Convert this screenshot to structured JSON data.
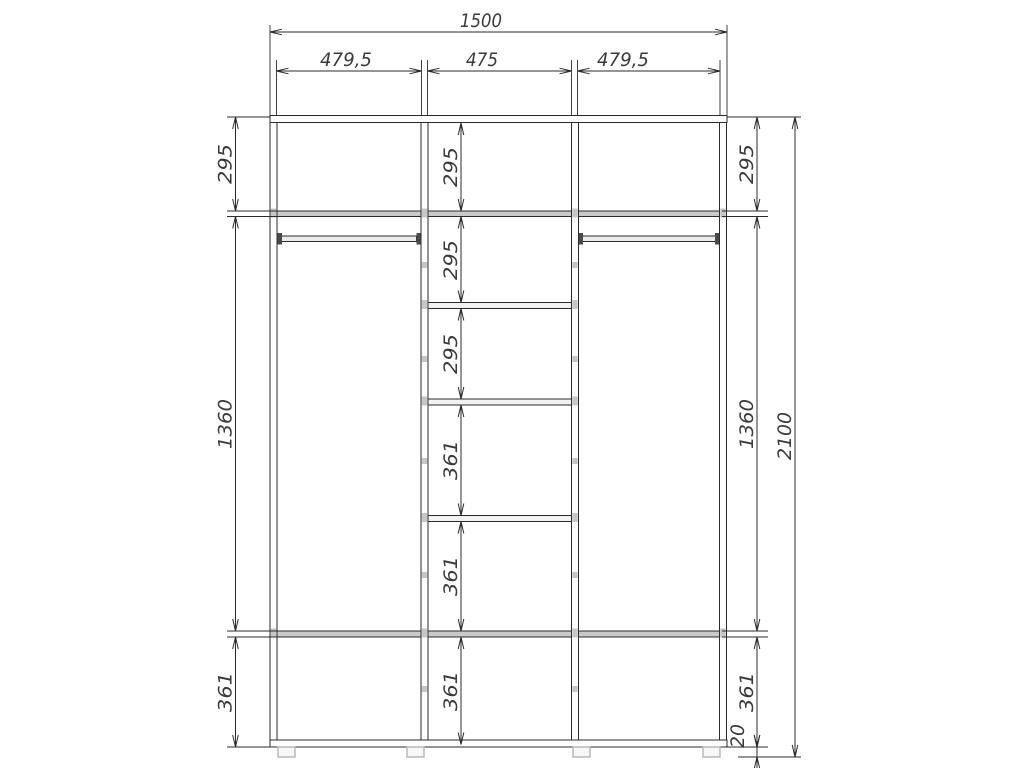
{
  "canvas": {
    "width": 1024,
    "height": 768,
    "background": "#ffffff"
  },
  "style": {
    "line_color": "#2b2b2b",
    "dim_color": "#2b2b2b",
    "text_color": "#3a3a3a",
    "font_size": 19,
    "kinds": {
      "panel": {
        "fill": "#fdfdfd",
        "stroke": "#2b2b2b",
        "sw": 1
      },
      "shelf": {
        "fill": "#c9c9c9",
        "stroke": "#2b2b2b",
        "sw": 1
      },
      "inner_shelf": {
        "fill": "#f2f2f2",
        "stroke": "#2b2b2b",
        "sw": 1
      },
      "rod": {
        "fill": "#ececec",
        "stroke": "#2b2b2b",
        "sw": 1
      },
      "bracket": {
        "fill": "#4a4a4a",
        "stroke": "none",
        "sw": 0
      },
      "foot": {
        "fill": "#f7f7f7",
        "stroke": "#b5b5b5",
        "sw": 1.4
      },
      "fastener": {
        "fill": "#c6c6c6",
        "stroke": "none",
        "sw": 0
      }
    }
  },
  "drawing": {
    "rects": [
      {
        "name": "top-shelf-full",
        "kind": "shelf",
        "x": 277,
        "y": 211,
        "w": 442.5,
        "h": 5.5
      },
      {
        "name": "bottom-shelf-full",
        "kind": "shelf",
        "x": 277,
        "y": 631,
        "w": 442.5,
        "h": 6
      },
      {
        "name": "middle-shelf-1",
        "kind": "inner_shelf",
        "x": 428,
        "y": 302.5,
        "w": 143.5,
        "h": 6
      },
      {
        "name": "middle-shelf-2",
        "kind": "inner_shelf",
        "x": 428,
        "y": 399,
        "w": 143.5,
        "h": 6
      },
      {
        "name": "middle-shelf-3",
        "kind": "inner_shelf",
        "x": 428,
        "y": 515.5,
        "w": 143.5,
        "h": 6
      },
      {
        "name": "hanging-rod-left",
        "kind": "rod",
        "x": 281.5,
        "y": 236,
        "w": 135,
        "h": 5.5
      },
      {
        "name": "hanging-rod-right",
        "kind": "rod",
        "x": 582.5,
        "y": 236,
        "w": 133,
        "h": 5.5
      },
      {
        "name": "rod-bracket",
        "kind": "bracket",
        "x": 277.5,
        "y": 233,
        "w": 4.5,
        "h": 11.5
      },
      {
        "name": "rod-bracket",
        "kind": "bracket",
        "x": 416.5,
        "y": 233,
        "w": 4.5,
        "h": 11.5
      },
      {
        "name": "rod-bracket",
        "kind": "bracket",
        "x": 578.5,
        "y": 233,
        "w": 4.5,
        "h": 11.5
      },
      {
        "name": "rod-bracket",
        "kind": "bracket",
        "x": 715,
        "y": 233,
        "w": 4.5,
        "h": 11.5
      },
      {
        "name": "top-panel",
        "kind": "panel",
        "x": 270,
        "y": 115.5,
        "w": 457,
        "h": 7
      },
      {
        "name": "bottom-panel",
        "kind": "panel",
        "x": 270,
        "y": 740,
        "w": 457,
        "h": 7
      },
      {
        "name": "left-side-panel",
        "kind": "panel",
        "x": 270,
        "y": 122.5,
        "w": 7,
        "h": 617.5
      },
      {
        "name": "left-partition",
        "kind": "panel",
        "x": 421,
        "y": 122.5,
        "w": 7,
        "h": 617.5
      },
      {
        "name": "right-partition",
        "kind": "panel",
        "x": 571.5,
        "y": 122.5,
        "w": 7,
        "h": 617.5
      },
      {
        "name": "right-side-panel",
        "kind": "panel",
        "x": 719.5,
        "y": 122.5,
        "w": 7,
        "h": 617.5
      },
      {
        "name": "fastener-mark",
        "kind": "fastener",
        "x": 421.8,
        "y": 208.5,
        "w": 5.4,
        "h": 9
      },
      {
        "name": "fastener-mark",
        "kind": "fastener",
        "x": 421.8,
        "y": 300,
        "w": 5.4,
        "h": 9
      },
      {
        "name": "fastener-mark",
        "kind": "fastener",
        "x": 421.8,
        "y": 396.5,
        "w": 5.4,
        "h": 9
      },
      {
        "name": "fastener-mark",
        "kind": "fastener",
        "x": 421.8,
        "y": 513,
        "w": 5.4,
        "h": 9
      },
      {
        "name": "fastener-mark",
        "kind": "fastener",
        "x": 421.8,
        "y": 628.5,
        "w": 5.4,
        "h": 9
      },
      {
        "name": "fastener-mark",
        "kind": "fastener",
        "x": 572.3,
        "y": 208.5,
        "w": 5.4,
        "h": 9
      },
      {
        "name": "fastener-mark",
        "kind": "fastener",
        "x": 572.3,
        "y": 300,
        "w": 5.4,
        "h": 9
      },
      {
        "name": "fastener-mark",
        "kind": "fastener",
        "x": 572.3,
        "y": 396.5,
        "w": 5.4,
        "h": 9
      },
      {
        "name": "fastener-mark",
        "kind": "fastener",
        "x": 572.3,
        "y": 513,
        "w": 5.4,
        "h": 9
      },
      {
        "name": "fastener-mark",
        "kind": "fastener",
        "x": 572.3,
        "y": 628.5,
        "w": 5.4,
        "h": 9
      },
      {
        "name": "fastener-mark",
        "kind": "fastener",
        "x": 270.8,
        "y": 208.5,
        "w": 5.4,
        "h": 9
      },
      {
        "name": "fastener-mark",
        "kind": "fastener",
        "x": 720.3,
        "y": 208.5,
        "w": 5.4,
        "h": 9
      },
      {
        "name": "fastener-mark",
        "kind": "fastener",
        "x": 270.8,
        "y": 628.5,
        "w": 5.4,
        "h": 9
      },
      {
        "name": "fastener-mark",
        "kind": "fastener",
        "x": 720.3,
        "y": 628.5,
        "w": 5.4,
        "h": 9
      },
      {
        "name": "fastener-mark",
        "kind": "fastener",
        "x": 421.8,
        "y": 262,
        "w": 5.4,
        "h": 6
      },
      {
        "name": "fastener-mark",
        "kind": "fastener",
        "x": 421.8,
        "y": 356,
        "w": 5.4,
        "h": 6
      },
      {
        "name": "fastener-mark",
        "kind": "fastener",
        "x": 421.8,
        "y": 458,
        "w": 5.4,
        "h": 6
      },
      {
        "name": "fastener-mark",
        "kind": "fastener",
        "x": 421.8,
        "y": 572,
        "w": 5.4,
        "h": 6
      },
      {
        "name": "fastener-mark",
        "kind": "fastener",
        "x": 421.8,
        "y": 686,
        "w": 5.4,
        "h": 6
      },
      {
        "name": "fastener-mark",
        "kind": "fastener",
        "x": 572.3,
        "y": 262,
        "w": 5.4,
        "h": 6
      },
      {
        "name": "fastener-mark",
        "kind": "fastener",
        "x": 572.3,
        "y": 356,
        "w": 5.4,
        "h": 6
      },
      {
        "name": "fastener-mark",
        "kind": "fastener",
        "x": 572.3,
        "y": 458,
        "w": 5.4,
        "h": 6
      },
      {
        "name": "fastener-mark",
        "kind": "fastener",
        "x": 572.3,
        "y": 572,
        "w": 5.4,
        "h": 6
      },
      {
        "name": "fastener-mark",
        "kind": "fastener",
        "x": 572.3,
        "y": 686,
        "w": 5.4,
        "h": 6
      },
      {
        "name": "foot",
        "kind": "foot",
        "x": 278,
        "y": 747,
        "w": 17,
        "h": 10
      },
      {
        "name": "foot",
        "kind": "foot",
        "x": 407,
        "y": 747,
        "w": 17,
        "h": 10
      },
      {
        "name": "foot",
        "kind": "foot",
        "x": 573,
        "y": 747,
        "w": 17,
        "h": 10
      },
      {
        "name": "foot",
        "kind": "foot",
        "x": 703,
        "y": 747,
        "w": 17,
        "h": 10
      }
    ],
    "extension_lines": [
      {
        "x1": 270,
        "y1": 25,
        "x2": 270,
        "y2": 115
      },
      {
        "x1": 276.5,
        "y1": 60,
        "x2": 276.5,
        "y2": 115
      },
      {
        "x1": 421.5,
        "y1": 60,
        "x2": 421.5,
        "y2": 115
      },
      {
        "x1": 427.5,
        "y1": 60,
        "x2": 427.5,
        "y2": 115
      },
      {
        "x1": 571.5,
        "y1": 60,
        "x2": 571.5,
        "y2": 115
      },
      {
        "x1": 577.5,
        "y1": 60,
        "x2": 577.5,
        "y2": 115
      },
      {
        "x1": 720,
        "y1": 60,
        "x2": 720,
        "y2": 115
      },
      {
        "x1": 727,
        "y1": 25,
        "x2": 727,
        "y2": 115
      },
      {
        "x1": 227,
        "y1": 117,
        "x2": 270,
        "y2": 117
      },
      {
        "x1": 227,
        "y1": 211,
        "x2": 277,
        "y2": 211
      },
      {
        "x1": 227,
        "y1": 216.5,
        "x2": 277,
        "y2": 216.5
      },
      {
        "x1": 227,
        "y1": 631,
        "x2": 277,
        "y2": 631
      },
      {
        "x1": 227,
        "y1": 637,
        "x2": 277,
        "y2": 637
      },
      {
        "x1": 227,
        "y1": 747,
        "x2": 270,
        "y2": 747
      },
      {
        "x1": 727,
        "y1": 117,
        "x2": 801,
        "y2": 117
      },
      {
        "x1": 722,
        "y1": 211,
        "x2": 768,
        "y2": 211
      },
      {
        "x1": 722,
        "y1": 216.5,
        "x2": 768,
        "y2": 216.5
      },
      {
        "x1": 722,
        "y1": 631,
        "x2": 768,
        "y2": 631
      },
      {
        "x1": 722,
        "y1": 637,
        "x2": 768,
        "y2": 637
      },
      {
        "x1": 722,
        "y1": 747,
        "x2": 768,
        "y2": 747
      },
      {
        "x1": 738,
        "y1": 757,
        "x2": 801,
        "y2": 757
      }
    ]
  },
  "dimensions": [
    {
      "label": "1500",
      "orient": "h",
      "x1": 270,
      "x2": 727,
      "y": 32,
      "lx": 481,
      "ly": 27,
      "tl": 42
    },
    {
      "label": "479,5",
      "orient": "h",
      "x1": 276.5,
      "x2": 421.5,
      "y": 71,
      "lx": 346,
      "ly": 66,
      "tl": 52
    },
    {
      "label": "475",
      "orient": "h",
      "x1": 427.5,
      "x2": 571.5,
      "y": 71,
      "lx": 482,
      "ly": 66,
      "tl": 32
    },
    {
      "label": "479,5",
      "orient": "h",
      "x1": 577.5,
      "x2": 720,
      "y": 71,
      "lx": 623,
      "ly": 66,
      "tl": 52
    },
    {
      "label": "295",
      "orient": "v",
      "x": 235.5,
      "y1": 117,
      "y2": 211,
      "lx": 231.5,
      "ly": 164,
      "tl": 40
    },
    {
      "label": "1360",
      "orient": "v",
      "x": 235.5,
      "y1": 216.5,
      "y2": 631,
      "lx": 231.5,
      "ly": 424,
      "tl": 50
    },
    {
      "label": "361",
      "orient": "v",
      "x": 235.5,
      "y1": 637,
      "y2": 747,
      "lx": 231.5,
      "ly": 692,
      "tl": 40
    },
    {
      "label": "295",
      "orient": "v",
      "x": 461,
      "y1": 123,
      "y2": 211,
      "lx": 457,
      "ly": 167,
      "tl": 40
    },
    {
      "label": "295",
      "orient": "v",
      "x": 461,
      "y1": 216.5,
      "y2": 302.5,
      "lx": 457,
      "ly": 260,
      "tl": 40
    },
    {
      "label": "295",
      "orient": "v",
      "x": 461,
      "y1": 308.5,
      "y2": 399,
      "lx": 457,
      "ly": 354,
      "tl": 40
    },
    {
      "label": "361",
      "orient": "v",
      "x": 461,
      "y1": 405,
      "y2": 515.5,
      "lx": 457,
      "ly": 460,
      "tl": 40
    },
    {
      "label": "361",
      "orient": "v",
      "x": 461,
      "y1": 521.5,
      "y2": 631,
      "lx": 457,
      "ly": 576,
      "tl": 40
    },
    {
      "label": "361",
      "orient": "v",
      "x": 461,
      "y1": 637,
      "y2": 744.5,
      "lx": 457,
      "ly": 691,
      "tl": 40
    },
    {
      "label": "295",
      "orient": "v",
      "x": 757,
      "y1": 117,
      "y2": 211,
      "lx": 753,
      "ly": 164,
      "tl": 40
    },
    {
      "label": "1360",
      "orient": "v",
      "x": 757,
      "y1": 216.5,
      "y2": 631,
      "lx": 753,
      "ly": 424,
      "tl": 50
    },
    {
      "label": "361",
      "orient": "v",
      "x": 757,
      "y1": 637,
      "y2": 747,
      "lx": 753,
      "ly": 692,
      "tl": 40
    },
    {
      "label": "20",
      "orient": "v",
      "x": 757,
      "y1": 747,
      "y2": 757,
      "lx": 744,
      "ly": 736,
      "tl": 24,
      "outside": true
    },
    {
      "label": "2100",
      "orient": "v",
      "x": 795,
      "y1": 117,
      "y2": 757,
      "lx": 791,
      "ly": 436,
      "tl": 48
    }
  ]
}
